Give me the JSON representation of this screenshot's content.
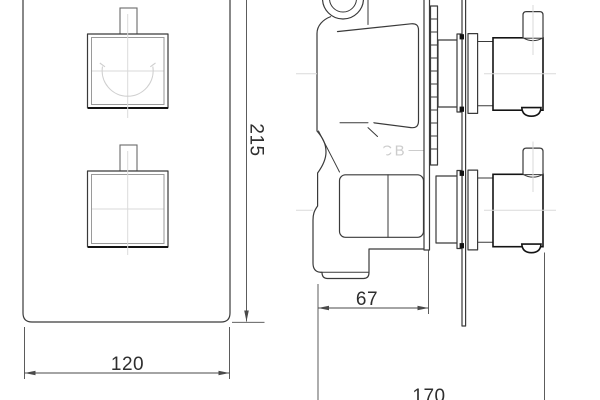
{
  "watermark": {
    "label": "DCB"
  },
  "dimensions": {
    "panel_height": "215",
    "panel_width": "120",
    "valve_body_depth": "67",
    "overall_depth": "170"
  },
  "colors": {
    "line": "#3a3a3a",
    "line_strong": "#141414",
    "dim": "#4a4a4a",
    "dim_text": "#2e2e2e",
    "centerline": "#dadada",
    "watermark": "#cccccc",
    "background": "#ffffff"
  }
}
